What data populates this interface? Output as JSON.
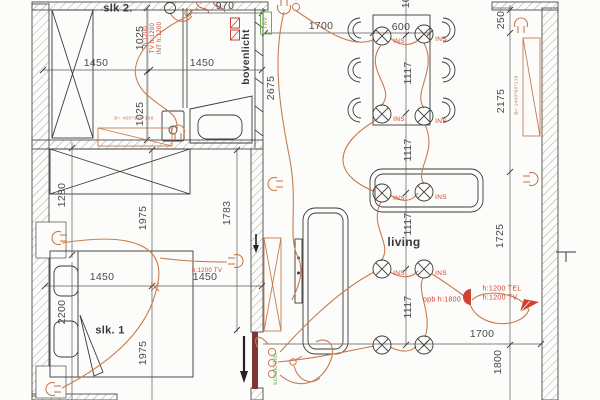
{
  "title": "electrical floor plan",
  "colors": {
    "ink": "#3a3a3a",
    "dim": "#4a4a4a",
    "cable": "#c97b50",
    "red": "#cf4130",
    "green": "#6fae4e",
    "maroon": "#7d3535",
    "hatch": "#a8a8a8"
  },
  "plan": {
    "rooms": [
      "slk 2.",
      "slk. 1",
      "living",
      "bovenlicht"
    ],
    "labels": [
      {
        "id": "room-slk2-label",
        "text": "slk 2.",
        "x": 118,
        "y": 9,
        "rot": 0,
        "color": "ink",
        "size": 11,
        "bold": true
      },
      {
        "id": "dim-970",
        "text": "970",
        "x": 225,
        "y": 6,
        "rot": 0,
        "color": "dim",
        "size": 10.5
      },
      {
        "id": "dim-1025-a",
        "text": "1025",
        "x": 140,
        "y": 38,
        "rot": -90,
        "color": "dim",
        "size": 10.5
      },
      {
        "id": "dim-1025-b",
        "text": "1025",
        "x": 140,
        "y": 114,
        "rot": -90,
        "color": "dim",
        "size": 10.5
      },
      {
        "id": "dim-1450-a",
        "text": "1450",
        "x": 96,
        "y": 63,
        "rot": 0,
        "color": "dim",
        "size": 10.5
      },
      {
        "id": "dim-1450-b",
        "text": "1450",
        "x": 202,
        "y": 63,
        "rot": 0,
        "color": "dim",
        "size": 10.5
      },
      {
        "id": "room-bovenlicht-label",
        "text": "bovenlicht",
        "x": 246,
        "y": 57,
        "rot": -90,
        "color": "ink",
        "size": 10.5,
        "bold": true
      },
      {
        "id": "dim-2675",
        "text": "2675",
        "x": 271,
        "y": 88,
        "rot": -90,
        "color": "dim",
        "size": 10.5
      },
      {
        "id": "dim-1700-top",
        "text": "1700",
        "x": 321,
        "y": 26,
        "rot": 0,
        "color": "dim",
        "size": 10.5
      },
      {
        "id": "dim-600",
        "text": "600",
        "x": 401,
        "y": 27,
        "rot": 0,
        "color": "dim",
        "size": 10.5
      },
      {
        "id": "dim-1025-top",
        "text": "1025",
        "x": 406,
        "y": -4,
        "rot": -90,
        "color": "dim",
        "size": 10.5
      },
      {
        "id": "dim-1117-a",
        "text": "1117",
        "x": 408,
        "y": 73,
        "rot": -90,
        "color": "dim",
        "size": 10.5
      },
      {
        "id": "dim-1117-b",
        "text": "1117",
        "x": 408,
        "y": 150,
        "rot": -90,
        "color": "dim",
        "size": 10.5
      },
      {
        "id": "dim-1117-c",
        "text": "1117",
        "x": 408,
        "y": 224,
        "rot": -90,
        "color": "dim",
        "size": 10.5
      },
      {
        "id": "dim-1117-d",
        "text": "1117",
        "x": 408,
        "y": 307,
        "rot": -90,
        "color": "dim",
        "size": 10.5
      },
      {
        "id": "dim-250",
        "text": "250",
        "x": 501,
        "y": 20,
        "rot": -90,
        "color": "dim",
        "size": 10.5
      },
      {
        "id": "dim-2175",
        "text": "2175",
        "x": 501,
        "y": 101,
        "rot": -90,
        "color": "dim",
        "size": 10.5
      },
      {
        "id": "dim-1725",
        "text": "1725",
        "x": 500,
        "y": 236,
        "rot": -90,
        "color": "dim",
        "size": 10.5
      },
      {
        "id": "dim-1280",
        "text": "1280",
        "x": 62,
        "y": 195,
        "rot": -90,
        "color": "dim",
        "size": 10.5
      },
      {
        "id": "dim-1975-a",
        "text": "1975",
        "x": 143,
        "y": 218,
        "rot": -90,
        "color": "dim",
        "size": 10.5
      },
      {
        "id": "dim-1783",
        "text": "1783",
        "x": 227,
        "y": 213,
        "rot": -90,
        "color": "dim",
        "size": 10.5
      },
      {
        "id": "dim-1450-c",
        "text": "1450",
        "x": 102,
        "y": 277,
        "rot": 0,
        "color": "dim",
        "size": 10.5
      },
      {
        "id": "dim-1450-d",
        "text": "1450",
        "x": 205,
        "y": 277,
        "rot": 0,
        "color": "dim",
        "size": 10.5
      },
      {
        "id": "dim-2200",
        "text": "2200",
        "x": 62,
        "y": 312,
        "rot": -90,
        "color": "dim",
        "size": 10.5
      },
      {
        "id": "room-slk1-label",
        "text": "slk. 1",
        "x": 110,
        "y": 331,
        "rot": 0,
        "color": "ink",
        "size": 11,
        "bold": true
      },
      {
        "id": "dim-1975-b",
        "text": "1975",
        "x": 143,
        "y": 353,
        "rot": -90,
        "color": "dim",
        "size": 10.5
      },
      {
        "id": "room-living-label",
        "text": "living",
        "x": 404,
        "y": 242,
        "rot": 0,
        "color": "ink",
        "size": 12,
        "bold": true
      },
      {
        "id": "dim-1700-bottom",
        "text": "1700",
        "x": 482,
        "y": 334,
        "rot": 0,
        "color": "dim",
        "size": 10.5
      },
      {
        "id": "dim-1800",
        "text": "1800",
        "x": 498,
        "y": 362,
        "rot": -90,
        "color": "dim",
        "size": 10.5
      },
      {
        "id": "note-h1200",
        "text": "h:1200",
        "x": 146,
        "y": 36,
        "rot": -90,
        "color": "red",
        "size": 6
      },
      {
        "id": "note-tv-h1200",
        "text": "TV h:1200",
        "x": 153,
        "y": 38,
        "rot": -90,
        "color": "red",
        "size": 6
      },
      {
        "id": "note-int-h1200",
        "text": "INT h:1200",
        "x": 160,
        "y": 38,
        "rot": -90,
        "color": "red",
        "size": 6
      },
      {
        "id": "note-radiator-slk2",
        "text": "B= 400*320*149",
        "x": 134,
        "y": 120,
        "rot": 0,
        "color": "cable",
        "size": 4.8
      },
      {
        "id": "note-radiator-right",
        "text": "B= 1400*60*219",
        "x": 518,
        "y": 95,
        "rot": -90,
        "color": "cable",
        "size": 4.8
      },
      {
        "id": "note-opb-h1800",
        "text": "opb h:1800",
        "x": 442,
        "y": 300,
        "rot": 0,
        "color": "red",
        "size": 7
      },
      {
        "id": "note-h1200-tel",
        "text": "h:1200 TEL",
        "x": 502,
        "y": 289,
        "rot": 0,
        "color": "red",
        "size": 7
      },
      {
        "id": "note-h1200-tv",
        "text": "h:1200 TV",
        "x": 500,
        "y": 298,
        "rot": 0,
        "color": "red",
        "size": 7
      },
      {
        "id": "note-slk1-tv",
        "text": "h:1200 TV",
        "x": 207,
        "y": 271,
        "rot": 0,
        "color": "red",
        "size": 6
      },
      {
        "id": "note-schak-dim",
        "text": "schak/dim",
        "x": 276,
        "y": 369,
        "rot": -90,
        "color": "green",
        "size": 6.5
      },
      {
        "id": "note-tnv",
        "text": "TNV",
        "x": 266,
        "y": 23,
        "rot": -90,
        "color": "green",
        "size": 6
      },
      {
        "id": "ins-1",
        "text": "INS",
        "x": 399,
        "y": 42,
        "rot": 0,
        "color": "red",
        "size": 6.5
      },
      {
        "id": "ins-2",
        "text": "INS",
        "x": 441,
        "y": 40,
        "rot": 0,
        "color": "red",
        "size": 6.5
      },
      {
        "id": "ins-3",
        "text": "INS",
        "x": 399,
        "y": 120,
        "rot": 0,
        "color": "red",
        "size": 6.5
      },
      {
        "id": "ins-4",
        "text": "INS",
        "x": 441,
        "y": 122,
        "rot": 0,
        "color": "red",
        "size": 6.5
      },
      {
        "id": "ins-5",
        "text": "INS",
        "x": 399,
        "y": 199,
        "rot": 0,
        "color": "red",
        "size": 6.5
      },
      {
        "id": "ins-6",
        "text": "INS",
        "x": 441,
        "y": 198,
        "rot": 0,
        "color": "red",
        "size": 6.5
      },
      {
        "id": "ins-7",
        "text": "INS",
        "x": 399,
        "y": 274,
        "rot": 0,
        "color": "red",
        "size": 6.5
      },
      {
        "id": "ins-8",
        "text": "INS",
        "x": 441,
        "y": 274,
        "rot": 0,
        "color": "red",
        "size": 6.5
      }
    ],
    "symbols": [
      {
        "name": "light-fixture-ins-1",
        "type": "fixture",
        "x": 382,
        "y": 36
      },
      {
        "name": "light-fixture-ins-2",
        "type": "fixture",
        "x": 424,
        "y": 34
      },
      {
        "name": "light-fixture-ins-3",
        "type": "fixture",
        "x": 382,
        "y": 114
      },
      {
        "name": "light-fixture-ins-4",
        "type": "fixture",
        "x": 424,
        "y": 116
      },
      {
        "name": "light-fixture-ins-5",
        "type": "fixture",
        "x": 382,
        "y": 193
      },
      {
        "name": "light-fixture-ins-6",
        "type": "fixture",
        "x": 424,
        "y": 192
      },
      {
        "name": "light-fixture-ins-7",
        "type": "fixture",
        "x": 382,
        "y": 269
      },
      {
        "name": "light-fixture-ins-8",
        "type": "fixture",
        "x": 424,
        "y": 269
      },
      {
        "name": "light-fixture-9",
        "type": "fixture",
        "x": 382,
        "y": 345
      },
      {
        "name": "light-fixture-10",
        "type": "fixture",
        "x": 424,
        "y": 345
      },
      {
        "name": "pendant-light-slk2",
        "type": "pendant",
        "x": 170,
        "y": 8
      },
      {
        "name": "wall-lamp-bath",
        "type": "lamp",
        "x": 178,
        "y": 133,
        "rot": 0
      },
      {
        "name": "wall-lamp-slk1-top",
        "type": "lamp",
        "x": 60,
        "y": 238,
        "rot": -90
      },
      {
        "name": "wall-lamp-slk1-bottom",
        "type": "lamp",
        "x": 54,
        "y": 389,
        "rot": -90
      },
      {
        "name": "wall-lamp-corridor-top",
        "type": "lamp",
        "x": 284,
        "y": 6,
        "rot": 180
      },
      {
        "name": "wall-lamp-top-right",
        "type": "lamp",
        "x": 521,
        "y": 26,
        "rot": 0
      },
      {
        "name": "wall-lamp-living-right",
        "type": "lamp",
        "x": 530,
        "y": 179,
        "rot": 90
      },
      {
        "name": "wall-lamp-living-left",
        "type": "lamp",
        "x": 276,
        "y": 184,
        "rot": -90
      },
      {
        "name": "wall-lamp-slk1-right",
        "type": "lamp",
        "x": 235,
        "y": 261,
        "rot": 90
      },
      {
        "name": "switch-slk2",
        "type": "switch",
        "x": 188,
        "y": 13,
        "rot": 20
      },
      {
        "name": "switch-corridor-top",
        "type": "swc",
        "x": 296,
        "y": 7
      },
      {
        "name": "switch-entry-1",
        "type": "swc",
        "x": 272,
        "y": 352
      },
      {
        "name": "switch-entry-2",
        "type": "swc",
        "x": 272,
        "y": 363
      },
      {
        "name": "switch-entry-3",
        "type": "swc",
        "x": 272,
        "y": 374
      },
      {
        "name": "switch-entry-4",
        "type": "switch",
        "x": 293,
        "y": 362,
        "rot": 10
      },
      {
        "name": "tel-tv-outlet",
        "type": "outlet",
        "x": 471,
        "y": 297,
        "rot": 180
      },
      {
        "name": "feed-arrow-icon",
        "type": "plane",
        "x": 529,
        "y": 306,
        "rot": 0
      },
      {
        "name": "tv-socket-slk2",
        "type": "socket",
        "x": 235,
        "y": 23
      },
      {
        "name": "int-socket-slk2",
        "type": "socket",
        "x": 235,
        "y": 35
      },
      {
        "name": "wall-tee-mark",
        "type": "tee",
        "x": 566,
        "y": 252
      },
      {
        "name": "tnv-box",
        "type": "gbox",
        "x": 266,
        "y": 23
      },
      {
        "name": "entrance-arrow",
        "type": "arrow",
        "x": 244,
        "y": 336
      },
      {
        "name": "wall-arrow",
        "type": "arrowsmall",
        "x": 256,
        "y": 234
      }
    ]
  }
}
